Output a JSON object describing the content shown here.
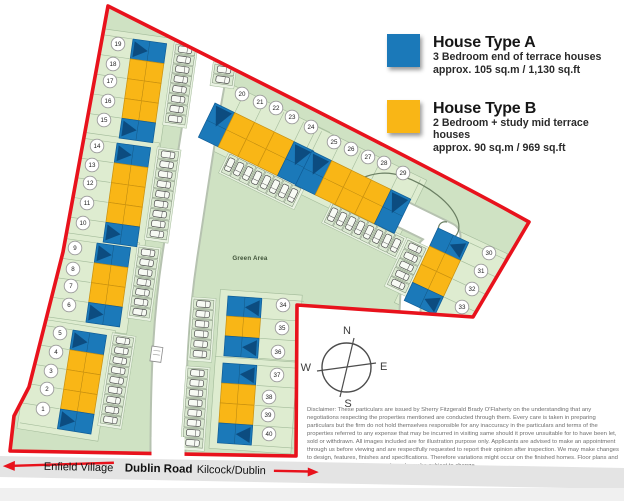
{
  "legend": {
    "items": [
      {
        "title": "House Type A",
        "desc": "3 Bedroom end of terrace houses",
        "size": "approx. 105 sq.m / 1,130 sq.ft",
        "color": "#1b79b9"
      },
      {
        "title": "House Type B",
        "desc": "2 Bedroom + study mid terrace houses",
        "size": "approx. 90 sq.m / 969 sq.ft",
        "color": "#f9b616"
      }
    ]
  },
  "compass": {
    "north": "N",
    "south": "S",
    "east": "E",
    "west": "W"
  },
  "road_band": {
    "left": "Enfield Village",
    "center": "Dublin Road",
    "right": "Kilcock/Dublin"
  },
  "disclaimer": "Disclaimer: These particulars are issued by Sherry Fitzgerald Brady O'Flaherty on the understanding that any negotiations respecting the properties mentioned are conducted through them. Every care is taken in preparing particulars but the firm do not hold themselves responsible for any inaccuracy in the particulars and terms of the properties referred to any expense that may be incurred in visiting same should it prove unsuitable for to have been let, sold or withdrawn. All images included are for illustration purpose only. Applicants are advised to make an appointment through us before viewing and are respectfully requested to report their opinion after inspection. We may make changes to design, features, finishes and specifications. Therefore variations might occur on the finished homes. Floor plans and dimensions are for reference only and may be subject to change.",
  "map": {
    "green_area_label": "Green Area",
    "colors": {
      "boundary": "#e8121c",
      "site_green": "#cfe2c3",
      "strip_green": "#deecd0",
      "strip_stroke": "#a3bb9a",
      "type_a": "#1b79b9",
      "type_a_stroke": "#0f5c96",
      "type_b": "#f9b616",
      "type_b_stroke": "#c8900f",
      "roof": "#0c4c80"
    },
    "plots": [
      {
        "n": 1,
        "x": 43,
        "y": 409,
        "type": "A"
      },
      {
        "n": 2,
        "x": 47,
        "y": 389,
        "type": "B"
      },
      {
        "n": 3,
        "x": 51,
        "y": 371,
        "type": "B"
      },
      {
        "n": 4,
        "x": 56,
        "y": 352,
        "type": "B"
      },
      {
        "n": 5,
        "x": 60,
        "y": 333,
        "type": "A"
      },
      {
        "n": 6,
        "x": 69,
        "y": 305,
        "type": "A"
      },
      {
        "n": 7,
        "x": 71,
        "y": 286,
        "type": "B"
      },
      {
        "n": 8,
        "x": 73,
        "y": 269,
        "type": "B"
      },
      {
        "n": 9,
        "x": 75,
        "y": 248,
        "type": "A"
      },
      {
        "n": 10,
        "x": 83,
        "y": 223,
        "type": "A"
      },
      {
        "n": 11,
        "x": 87,
        "y": 203,
        "type": "B"
      },
      {
        "n": 12,
        "x": 90,
        "y": 183,
        "type": "B"
      },
      {
        "n": 13,
        "x": 92,
        "y": 165,
        "type": "B"
      },
      {
        "n": 14,
        "x": 97,
        "y": 146,
        "type": "A"
      },
      {
        "n": 15,
        "x": 104,
        "y": 120,
        "type": "A"
      },
      {
        "n": 16,
        "x": 108,
        "y": 101,
        "type": "B"
      },
      {
        "n": 17,
        "x": 110,
        "y": 81,
        "type": "B"
      },
      {
        "n": 18,
        "x": 113,
        "y": 64,
        "type": "B"
      },
      {
        "n": 19,
        "x": 118,
        "y": 44,
        "type": "A"
      },
      {
        "n": 20,
        "x": 242,
        "y": 94,
        "type": "A"
      },
      {
        "n": 21,
        "x": 260,
        "y": 102,
        "type": "B"
      },
      {
        "n": 22,
        "x": 276,
        "y": 108,
        "type": "B"
      },
      {
        "n": 23,
        "x": 292,
        "y": 117,
        "type": "B"
      },
      {
        "n": 24,
        "x": 311,
        "y": 127,
        "type": "A"
      },
      {
        "n": 25,
        "x": 334,
        "y": 142,
        "type": "A"
      },
      {
        "n": 26,
        "x": 351,
        "y": 149,
        "type": "B"
      },
      {
        "n": 27,
        "x": 368,
        "y": 157,
        "type": "B"
      },
      {
        "n": 28,
        "x": 384,
        "y": 163,
        "type": "B"
      },
      {
        "n": 29,
        "x": 403,
        "y": 173,
        "type": "A"
      },
      {
        "n": 30,
        "x": 489,
        "y": 253,
        "type": "A"
      },
      {
        "n": 31,
        "x": 481,
        "y": 271,
        "type": "B"
      },
      {
        "n": 32,
        "x": 472,
        "y": 289,
        "type": "B"
      },
      {
        "n": 33,
        "x": 462,
        "y": 307,
        "type": "A"
      },
      {
        "n": 34,
        "x": 283,
        "y": 305,
        "type": "A"
      },
      {
        "n": 35,
        "x": 282,
        "y": 328,
        "type": "B"
      },
      {
        "n": 36,
        "x": 278,
        "y": 352,
        "type": "A"
      },
      {
        "n": 37,
        "x": 277,
        "y": 375,
        "type": "A"
      },
      {
        "n": 38,
        "x": 269,
        "y": 397,
        "type": "B"
      },
      {
        "n": 39,
        "x": 268,
        "y": 415,
        "type": "B"
      },
      {
        "n": 40,
        "x": 269,
        "y": 434,
        "type": "A"
      }
    ],
    "blocks": [
      {
        "plots": "15-19",
        "x": 133,
        "y": 39,
        "rot": 8,
        "dir": "v",
        "cells": [
          "A",
          "B",
          "B",
          "B",
          "A"
        ],
        "chev": "e",
        "nside": "w"
      },
      {
        "plots": "10-14",
        "x": 117,
        "y": 143,
        "rot": 8,
        "dir": "v",
        "cells": [
          "A",
          "B",
          "B",
          "B",
          "A"
        ],
        "chev": "e",
        "nside": "w"
      },
      {
        "plots": "6-9",
        "x": 97,
        "y": 243,
        "rot": 8,
        "dir": "v",
        "cells": [
          "A",
          "B",
          "B",
          "A"
        ],
        "chev": "e",
        "nside": "w"
      },
      {
        "plots": "1-5",
        "x": 73,
        "y": 330,
        "rot": 9,
        "dir": "v",
        "cells": [
          "A",
          "B",
          "B",
          "B",
          "A"
        ],
        "chev": "e",
        "nside": "w"
      },
      {
        "plots": "20-24",
        "x": 215,
        "y": 103,
        "rot": 26,
        "dir": "h",
        "cells": [
          "A",
          "B",
          "B",
          "B",
          "A"
        ],
        "chev": "s",
        "nside": "n"
      },
      {
        "plots": "25-29",
        "x": 312,
        "y": 151,
        "rot": 26,
        "dir": "h",
        "cells": [
          "A",
          "B",
          "B",
          "B",
          "A"
        ],
        "chev": "s",
        "nside": "n"
      },
      {
        "plots": "30-33",
        "x": 438,
        "y": 228,
        "rot": 25,
        "dir": "v",
        "cells": [
          "A",
          "B",
          "B",
          "A"
        ],
        "chev": "w",
        "nside": "e"
      },
      {
        "plots": "34-36",
        "x": 228,
        "y": 296,
        "rot": 4,
        "dir": "v",
        "cells": [
          "A",
          "B",
          "A"
        ],
        "chev": "w",
        "nside": "e"
      },
      {
        "plots": "37-40",
        "x": 223,
        "y": 363,
        "rot": 4,
        "dir": "v",
        "cells": [
          "A",
          "B",
          "B",
          "A"
        ],
        "chev": "w",
        "nside": "e"
      }
    ]
  }
}
